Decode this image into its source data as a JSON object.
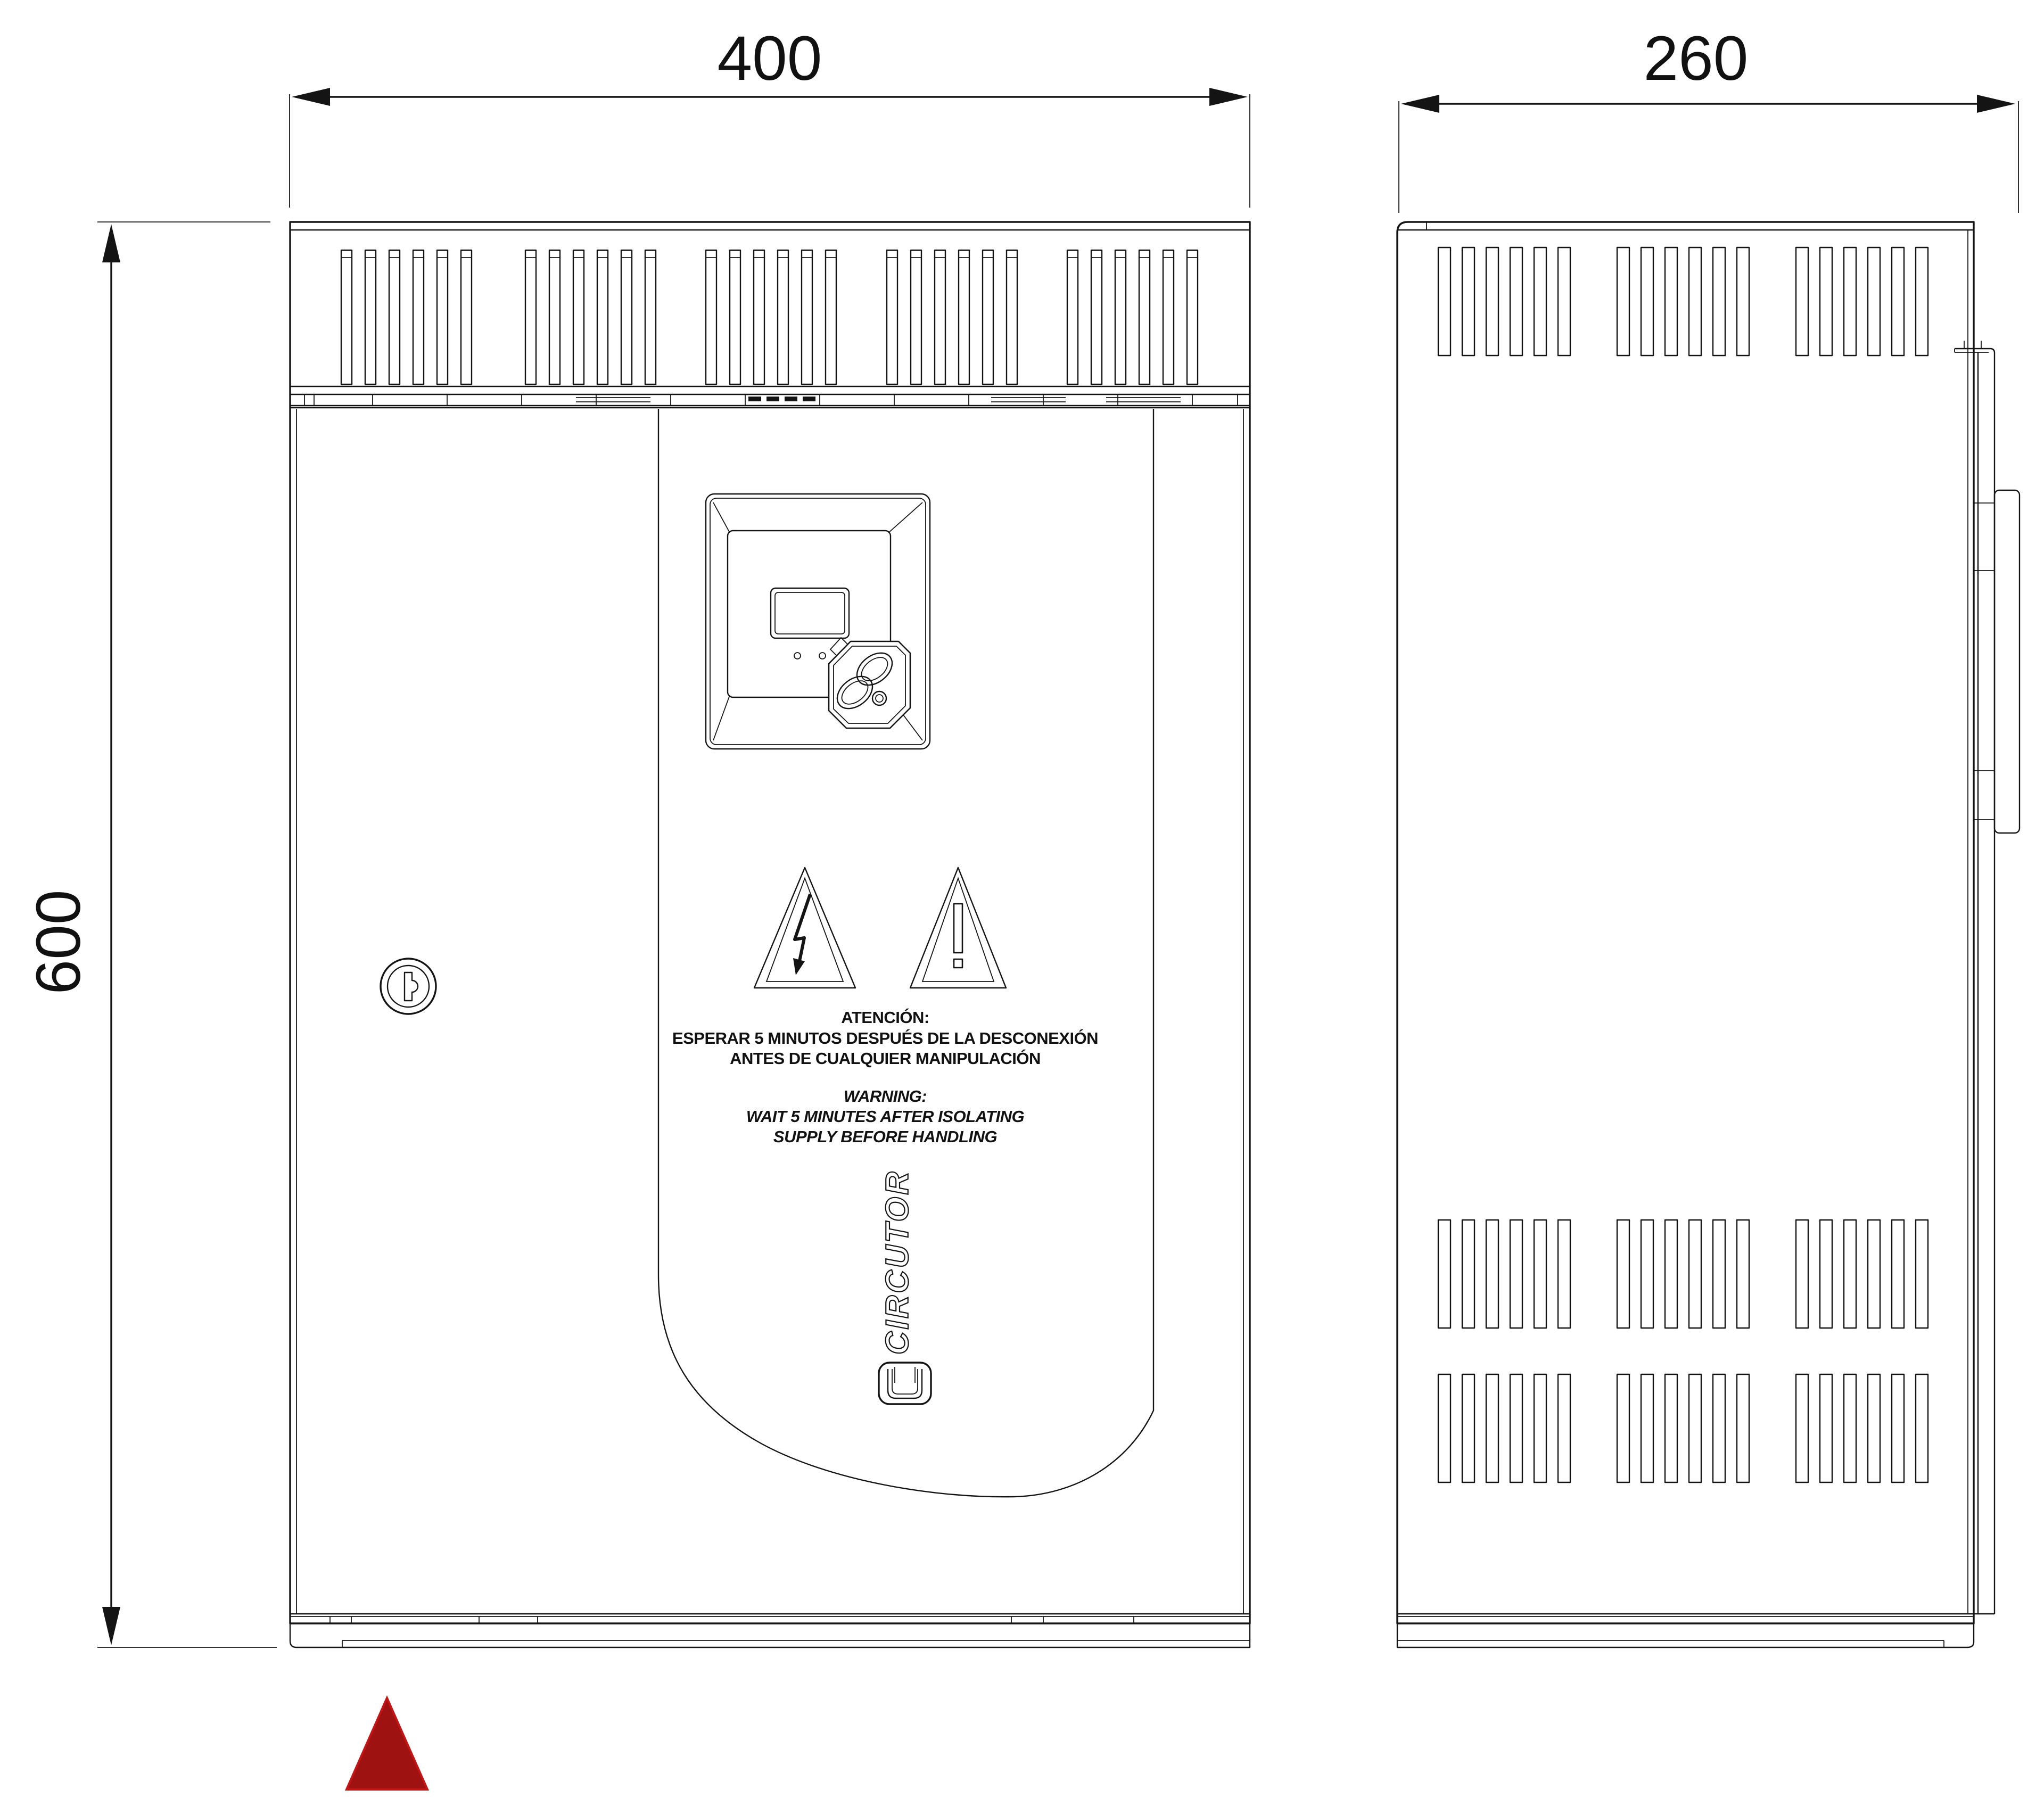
{
  "dimensions": {
    "front_width": "400",
    "side_depth": "260",
    "height": "600"
  },
  "warning_es": {
    "title": "ATENCIÓN:",
    "line1": "ESPERAR 5 MINUTOS DESPUÉS DE LA DESCONEXIÓN",
    "line2": "ANTES DE CUALQUIER MANIPULACIÓN"
  },
  "warning_en": {
    "title": "WARNING:",
    "line1": "WAIT 5 MINUTES AFTER ISOLATING",
    "line2": "SUPPLY BEFORE HANDLING"
  },
  "brand": {
    "name": "CIRCUTOR"
  },
  "colors": {
    "line": "#141414",
    "marker_red": "#9e1212",
    "marker_red_edge": "#c41414"
  },
  "icons": {
    "electric_hazard": "lightning-triangle-icon",
    "general_warning": "exclamation-triangle-icon",
    "lock": "keyhole-icon",
    "orientation_marker": "red-triangle-marker"
  }
}
